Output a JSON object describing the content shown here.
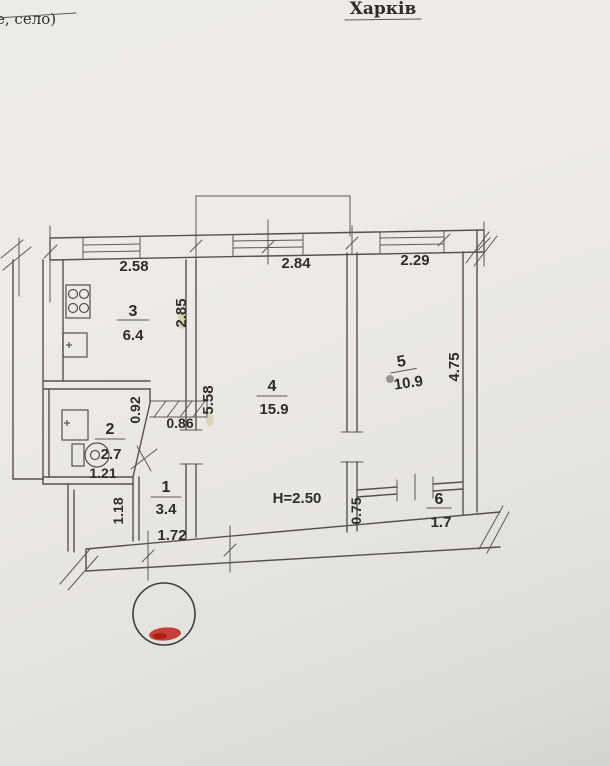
{
  "document": {
    "title": "Харків",
    "corner_note": "е, село)"
  },
  "plan": {
    "height_label": "H=2.50",
    "rooms": {
      "r1": {
        "number": "1",
        "area": "3.4"
      },
      "r2": {
        "number": "2",
        "area": "2.7"
      },
      "r3": {
        "number": "3",
        "area": "6.4"
      },
      "r4": {
        "number": "4",
        "area": "15.9"
      },
      "r5": {
        "number": "5",
        "area": "10.9"
      },
      "r6": {
        "number": "6",
        "area": "1.7"
      }
    },
    "dims": {
      "top_kitchen": "2.58",
      "top_living": "2.84",
      "top_bedroom": "2.29",
      "kitchen_depth": "2.85",
      "living_depth": "5.58",
      "bedroom_depth": "4.75",
      "lobby_width": "0.86",
      "lobby_depth": "0.92",
      "bath_width": "1.21",
      "hall_depth": "1.18",
      "hall_width": "1.72",
      "closet_depth": "0.75"
    },
    "stamp_color": "#bf2318",
    "line_color": "#55524b"
  }
}
